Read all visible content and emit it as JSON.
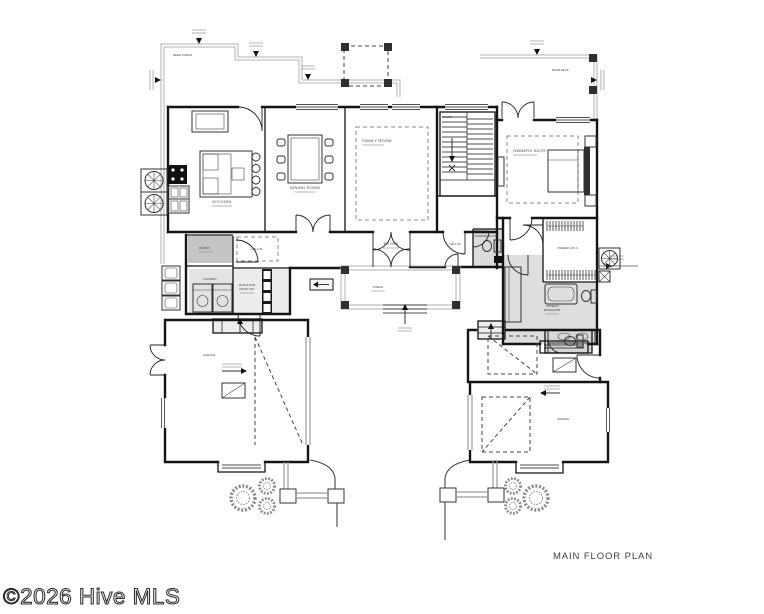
{
  "plan": {
    "title": "MAIN FLOOR PLAN",
    "watermark": "©2026 Hive MLS"
  },
  "rooms": {
    "rear_porch": "REAR PORCH",
    "rear_deck": "REAR DECK",
    "kitchen": "KITCHEN",
    "dining_room": "DINING ROOM",
    "family_room": "FAMILY ROOM",
    "stairs": "STAIRS",
    "owners_suite": "OWNERS SUITE",
    "pantry": "PANTRY",
    "hall_1": "HALL #1",
    "laundry": "LAUNDRY",
    "mud_room_line1": "MUD ROOM",
    "mud_room_line2": "DROP OFF",
    "foyer": "FOYER",
    "porch": "PORCH",
    "hall_2": "HALL #2",
    "powder_room": "POWDER ROOM",
    "owners_wic": "OWNERS W.I.C.",
    "owners_bath_line1": "OWNERS",
    "owners_bath_line2": "BATHROOM",
    "garage_left": "GARAGE",
    "garage_right": "GARAGE"
  },
  "colors": {
    "walls": "#141414",
    "porch_outline": "#b0b0b0",
    "room_label": "#35475a",
    "pantry_fill": "#c4c4c4",
    "light_gray_fill": "#e3e3e3",
    "bath_fill": "#dedede",
    "watermark": "#2e2e2e",
    "background": "#ffffff"
  }
}
